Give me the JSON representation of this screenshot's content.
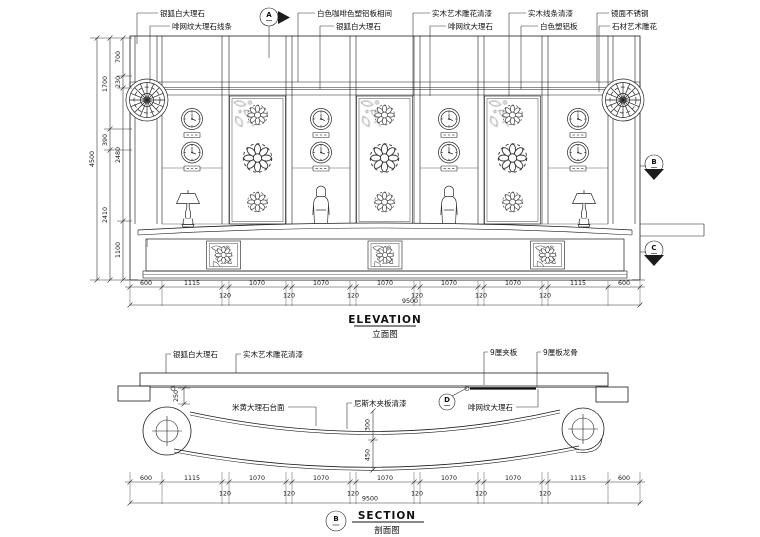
{
  "colors": {
    "paper": "#ffffff",
    "ink": "#1c1c1c"
  },
  "elevation": {
    "title_en": "ELEVATION",
    "title_cn": "立面图",
    "callouts": [
      "银狐白大理石",
      "啡网纹大理石线条",
      "白色咖啡色塑铝板相间",
      "银狐白大理石",
      "实木艺术雕花清漆",
      "啡网纹大理石",
      "实木线条清漆",
      "白色塑铝板",
      "镜面不锈钢",
      "石材艺术雕花"
    ],
    "markers": {
      "a": "A",
      "b": "B",
      "c": "C"
    },
    "dims": {
      "overall_height": "4500",
      "height_outer": [
        "1700",
        "390",
        "2410"
      ],
      "height_inner": [
        "700",
        "230",
        "2480",
        "1100"
      ],
      "bottom": [
        "600",
        "1115",
        "120",
        "1070",
        "120",
        "1070",
        "120",
        "1070",
        "120",
        "1070",
        "120",
        "1070",
        "120",
        "1115",
        "600"
      ],
      "total_width": "9500"
    }
  },
  "section": {
    "title_en": "SECTION",
    "title_cn": "剖面图",
    "markers": {
      "b": "B",
      "d": "D"
    },
    "callouts": [
      "银狐白大理石",
      "实木艺术雕花清漆",
      "9厘夹板",
      "9厘板龙骨",
      "米黄大理石台面",
      "尼斯木夹板清漆",
      "啡网纹大理石"
    ],
    "dims": {
      "step": "250",
      "counter_depth": "300",
      "front_depth": "450",
      "bottom": [
        "600",
        "1115",
        "120",
        "1070",
        "120",
        "1070",
        "120",
        "1070",
        "120",
        "1070",
        "120",
        "1070",
        "120",
        "1115",
        "600"
      ],
      "total_width": "9500"
    }
  }
}
